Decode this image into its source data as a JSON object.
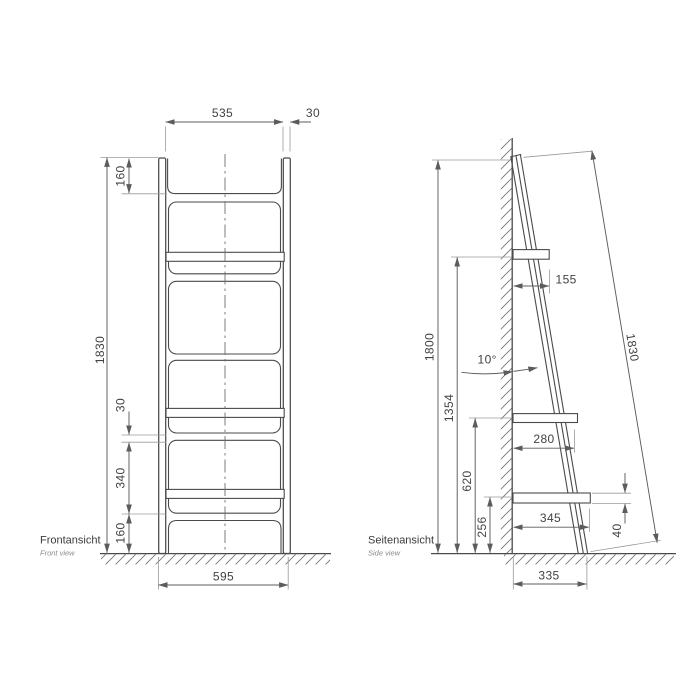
{
  "colors": {
    "background": "#ffffff",
    "object_line": "#4a4a4a",
    "dimension_line": "#5c5c5c",
    "extension_line": "#9a9a9a"
  },
  "front_view": {
    "label": "Frontansicht",
    "sublabel": "Front view",
    "dims": {
      "inner_width": "535",
      "profile_width": "30",
      "height": "1830",
      "top_section": "160",
      "shelf_front_thickness": "30",
      "shelf_spacing": "340",
      "bottom_section": "160",
      "outer_width": "595"
    }
  },
  "side_view": {
    "label": "Seitenansicht",
    "sublabel": "Side view",
    "dims": {
      "height": "1800",
      "top_shelf_height": "1354",
      "mid_shelf_height": "620",
      "bottom_shelf_height": "256",
      "top_shelf_depth": "155",
      "mid_shelf_depth": "280",
      "bottom_shelf_depth": "345",
      "shelf_thickness": "40",
      "base_depth": "335",
      "tilt_angle": "10°",
      "rail_length": "1830"
    }
  }
}
